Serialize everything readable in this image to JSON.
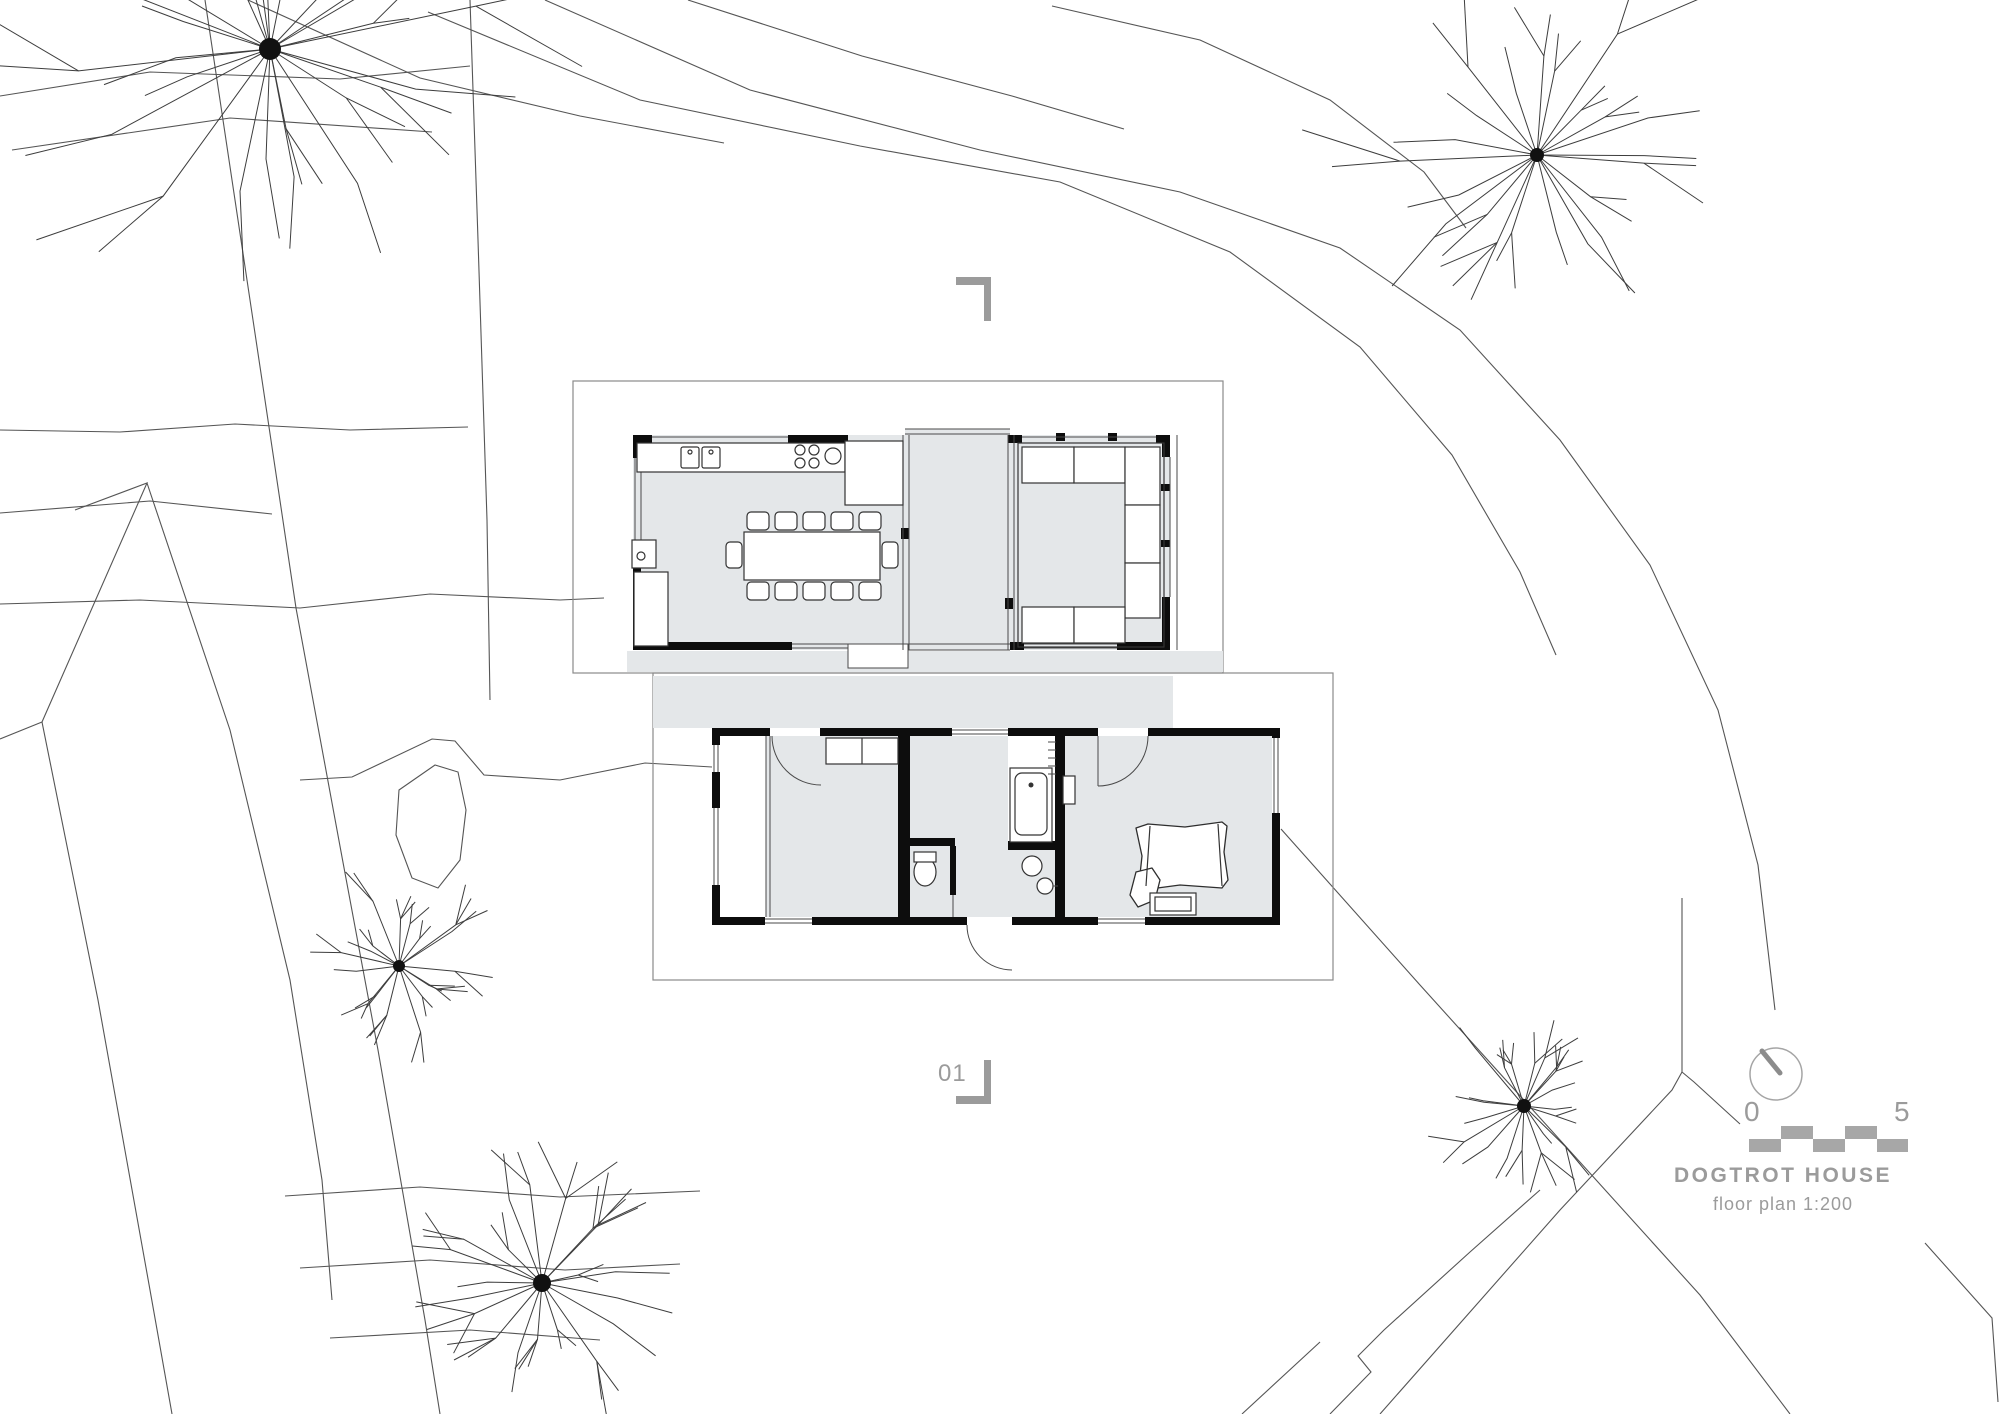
{
  "meta": {
    "title": "DOGTROT HOUSE",
    "subtitle": "floor plan 1:200"
  },
  "scale_bar": {
    "start_label": "0",
    "end_label": "5"
  },
  "section_marker": {
    "label": "01"
  },
  "colors": {
    "floor": "#e4e7e9",
    "wall": "#0d0d0d",
    "site_line": "#555555",
    "roof_line": "#8a8a8a",
    "ui_gray": "#9b9b9b",
    "bar_gray": "#a7a7a7"
  },
  "site": {
    "contours": [
      "545,0 750,90 980,150 1180,192 1340,248 1460,330 1560,440 1650,565 1718,710 1758,865 1775,1010",
      "428,12 640,100 860,146 1060,182 1230,252 1360,347 1452,455 1520,572 1556,655",
      "248,0 420,78 580,116 724,143",
      "1052,6 1200,40 1330,100 1424,172 1466,228",
      "688,0 862,56 1012,96 1124,129",
      "0,430 120,432 235,424 350,430 468,427",
      "0,513 150,501 272,514",
      "0,604 140,600 300,608 430,594 560,600 604,598",
      "300,780 352,777 432,739 455,741 484,775 560,780 645,763 712,767",
      "285,1196 420,1187 560,1197 700,1191",
      "300,1268 430,1260 565,1270 680,1264",
      "330,1338 470,1330 600,1340",
      "0,96 150,72 340,79 470,66",
      "12,150 230,118 432,132"
    ],
    "pond": "399,790 435,765 458,772 466,810 460,860 438,888 412,878 396,835",
    "boundaries": [
      "205,0 262,380 296,608 342,857 378,1050 425,1320 440,1414",
      "470,0 478,240 487,520 490,700",
      "75,510 147,483 42,722",
      "42,722 0,739",
      "42,722 98,1000 150,1290 172,1414",
      "147,483 230,730 290,980 322,1180 332,1300",
      "1281,829 1420,985 1560,1140 1700,1295 1790,1414",
      "1380,1414 1560,1210 1672,1090 1682,1072 1682,898",
      "1682,1072 1694,1082 1740,1124",
      "1330,1414 1371,1372 1358,1356 1384,1330 1470,1252 1540,1190",
      "1242,1414 1320,1342",
      "1925,1243 1992,1318 1998,1402"
    ],
    "trees": [
      {
        "cx": 270,
        "cy": 49,
        "r": 295,
        "dot": 11,
        "n": 26,
        "seed": 7
      },
      {
        "cx": 1537,
        "cy": 155,
        "r": 215,
        "dot": 7,
        "n": 22,
        "seed": 11
      },
      {
        "cx": 1524,
        "cy": 1106,
        "r": 102,
        "dot": 7,
        "n": 20,
        "seed": 3
      },
      {
        "cx": 399,
        "cy": 966,
        "r": 108,
        "dot": 6,
        "n": 18,
        "seed": 5
      },
      {
        "cx": 542,
        "cy": 1283,
        "r": 140,
        "dot": 9,
        "n": 20,
        "seed": 9
      }
    ]
  }
}
